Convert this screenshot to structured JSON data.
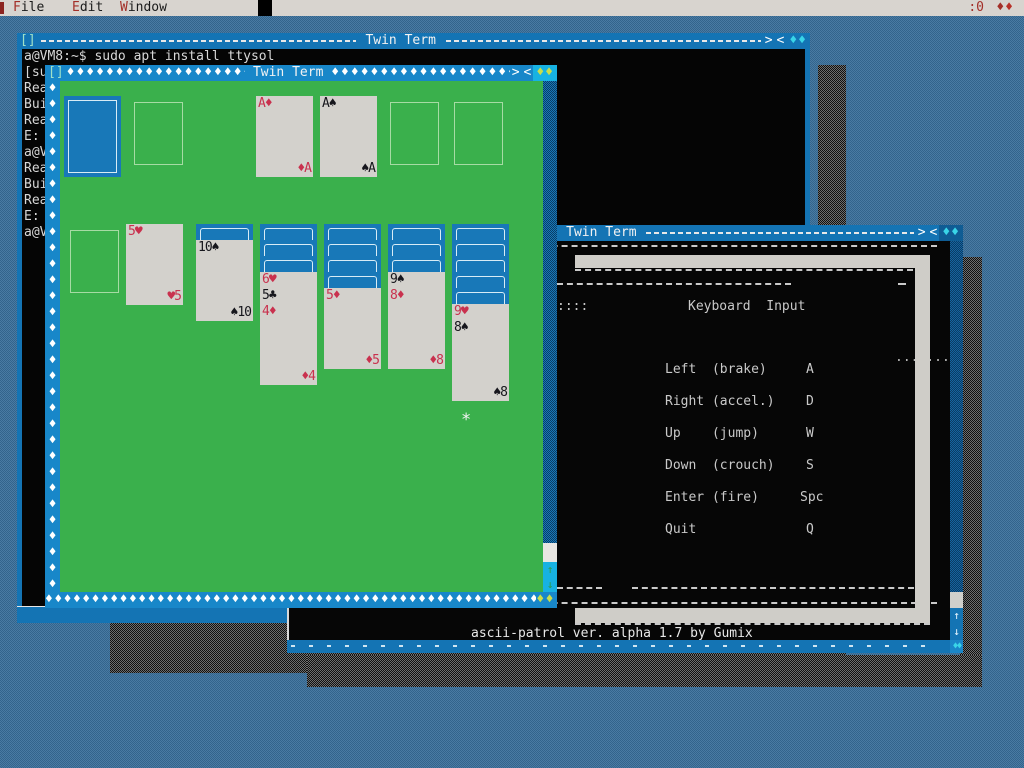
{
  "theme": {
    "desktop_blue": "#4a7ba3",
    "window_blue": "#1474b4",
    "active_title_blue": "#1887c9",
    "scroll_cyan": "#17b2e2",
    "felt_green": "#3ab04c",
    "card_red": "#c9314e",
    "card_back_blue": "#1878b8",
    "resize_yellow": "#cade4a",
    "menubar_gray": "#d8d4cf"
  },
  "glyphs": {
    "diamond": "♦",
    "double_diamond": "♦♦",
    "dot": ".",
    "up_arrow": "↑",
    "down_arrow": "↓",
    "maximize": ">",
    "restore": "<",
    "window_menu": "[]",
    "mouse_pointer": "*"
  },
  "menu_bar": {
    "items": [
      "File",
      "Edit",
      "Window"
    ],
    "display_id": ":0",
    "indicator": "♦♦"
  },
  "terminal_window": {
    "title": " Twin Term ",
    "prompt_line": "a@VM8:~$ sudo apt install ttysol",
    "truncated_lines": [
      "[su",
      "Rea",
      "Bui",
      "Rea",
      "E:",
      "a@V",
      "Rea",
      "Bui",
      "Rea",
      "E:",
      "a@V"
    ]
  },
  "solitaire_window": {
    "title": " Twin Term ",
    "cards": {
      "f1": {
        "tl": "A♦",
        "br": "♦A"
      },
      "f2": {
        "tl": "A♠",
        "br": "♠A"
      },
      "t2": {
        "tl": "5♥",
        "br": "♥5"
      },
      "t3": {
        "tl": "10♠",
        "br": "♠10"
      },
      "t4a": {
        "tl": "6♥"
      },
      "t4b": {
        "tl": "5♣"
      },
      "t4c": {
        "tl": "4♦",
        "br": "♦4"
      },
      "t5": {
        "tl": "5♦",
        "br": "♦5"
      },
      "t6a": {
        "tl": "9♠"
      },
      "t6b": {
        "tl": "8♦",
        "br": "♦8"
      },
      "t7a": {
        "tl": "9♥"
      },
      "t7b": {
        "tl": "8♠",
        "br": "♠8"
      }
    }
  },
  "ascii_window": {
    "title": " Twin Term ",
    "left_marks": "::::",
    "heading": "Keyboard  Input",
    "menu_rows": [
      {
        "action": "Left  (brake)",
        "key": "A"
      },
      {
        "action": "Right (accel.)",
        "key": "D"
      },
      {
        "action": "Up    (jump)",
        "key": "W"
      },
      {
        "action": "Down  (crouch)",
        "key": "S"
      },
      {
        "action": "Enter (fire)",
        "key": "Spc"
      },
      {
        "action": "Quit",
        "key": "Q"
      }
    ],
    "status_line": "ascii-patrol ver. alpha 1.7 by Gumix"
  }
}
